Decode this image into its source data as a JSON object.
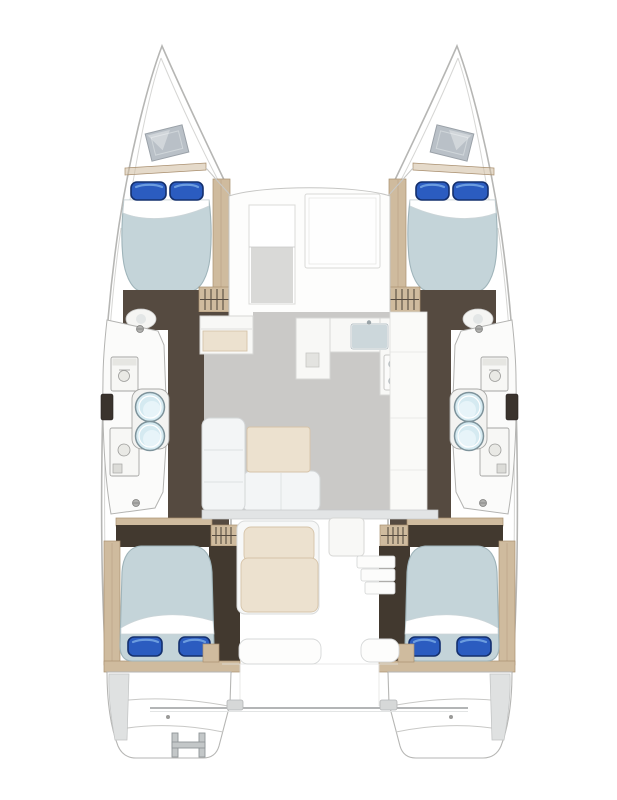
{
  "diagram": {
    "type": "floor-plan",
    "subject": "catamaran yacht accommodation layout, top-down view",
    "hulls": 2,
    "double_berths": 4,
    "pillows_per_berth": 2,
    "pillows_total": 8,
    "wash_basins_total": 4,
    "toilets_total": 4,
    "bow_hatches": 2,
    "stove_burners": 4,
    "swim_ladders": 1
  },
  "colors": {
    "background": "#ffffff",
    "hullFill": "#ffffff",
    "hullLine": "#b6b6b4",
    "deckLine": "#c8c8c6",
    "mattress": "#c4d4d9",
    "mattressEdge": "#9fb4ba",
    "pillow": "#2b5cc0",
    "pillowDark": "#14306e",
    "pillowLight": "#6f9fe0",
    "sheet": "#ffffff",
    "sheetEdge": "#ccd5d8",
    "darkFloor": "#554a40",
    "darkFloorDeep": "#42392f",
    "woodTan": "#cfbb9e",
    "woodTanDark": "#a98f6f",
    "stepLine": "#574c41",
    "saloonFloor": "#cac9c7",
    "furnitureWhite": "#f8f8f6",
    "furnitureLine": "#d7d7d5",
    "cream": "#ece1cf",
    "creamEdge": "#d6c4a9",
    "sinkBlue": "#d5eaf1",
    "sinkRing": "#7e939b",
    "hatchGray": "#b9c0c7",
    "hatchEdge": "#9aa1a8"
  }
}
